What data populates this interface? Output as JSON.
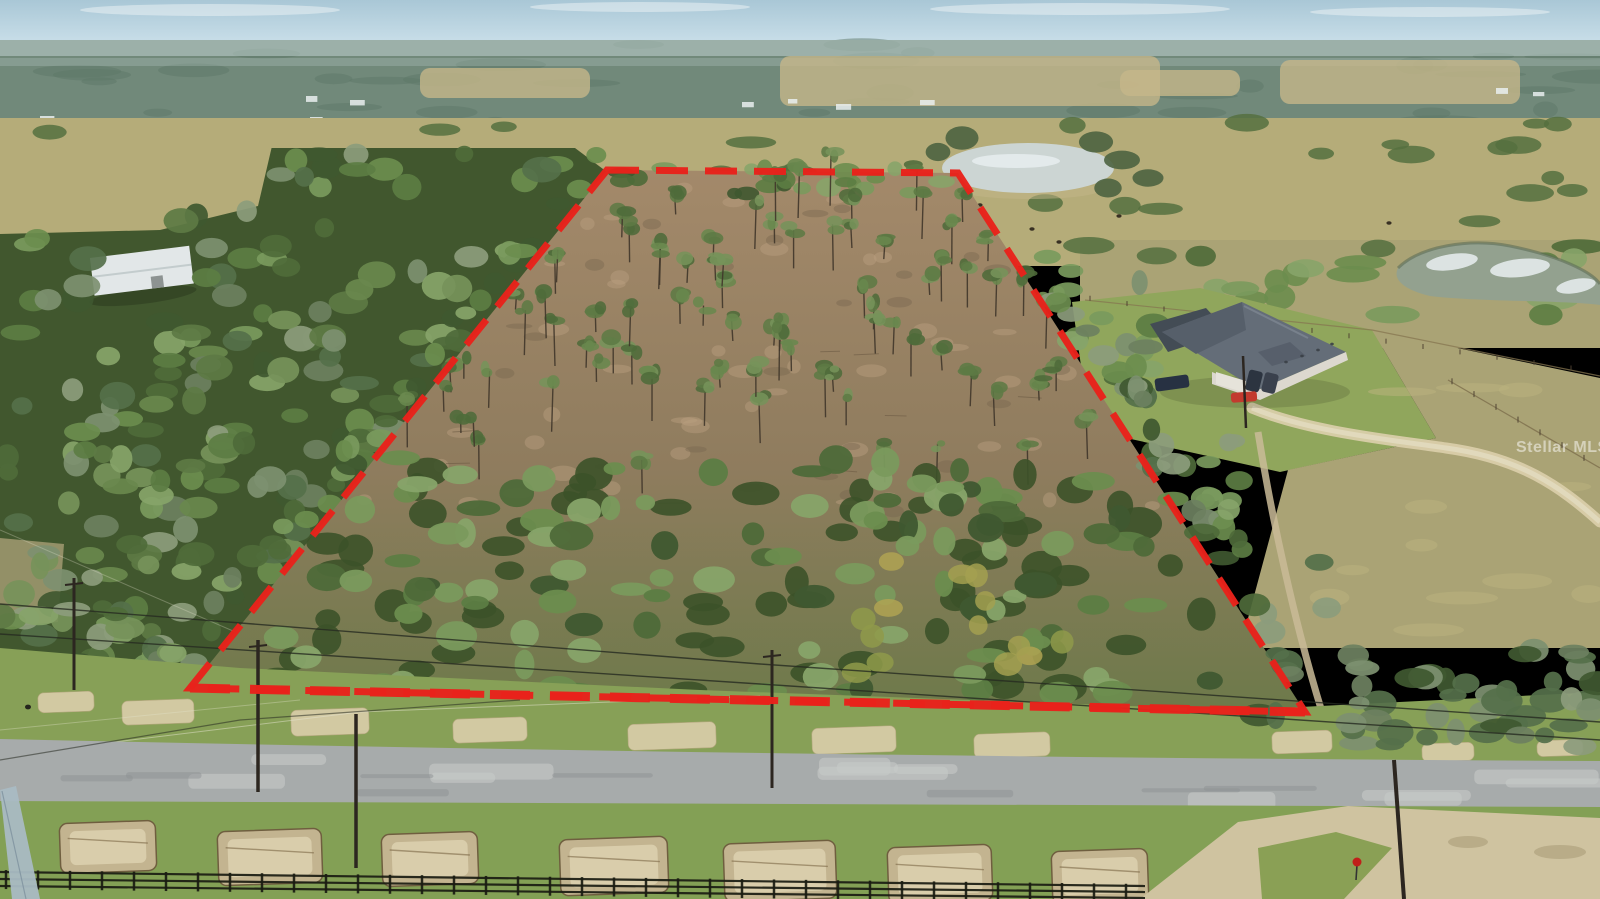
{
  "image": {
    "kind": "aerial-photograph",
    "width": 1600,
    "height": 899,
    "description": "Drone aerial photo of a wooded rural land parcel outlined with a red dashed property boundary, bordered by a country road with utility poles and a black board fence in the foreground, a neighboring house with a gray roof and cars to the right, pastures, cattle and ponds in the distance"
  },
  "watermark": {
    "text": "Stellar MLS",
    "x": 1516,
    "y": 439,
    "font_size": 16,
    "color": "rgba(255,255,255,0.5)"
  },
  "colors": {
    "sky_top": "#a9c7d6",
    "sky_low": "#cbe0ea",
    "cloud": "#eef4f6",
    "haze": "#c8d8d8",
    "distant": "#71897a",
    "distant_dark": "#5d7767",
    "field": "#c6b78a",
    "speck": "#e9eeef",
    "pasture": "#b5ac79",
    "pasture_right": "#aaa375",
    "lawn": "#90a65c",
    "dirt_top": "#a3896a",
    "dirt_low": "#8f7c5e",
    "dirt_light": "#bb9f80",
    "dirt_dark": "#76634d",
    "road": "#a7abab",
    "road_light": "#c6c9c8",
    "road_dark": "#8e9293",
    "verge": "#87a057",
    "sand": "#d9cda9",
    "sand_dark": "#b7a880",
    "fg_green": "#83a055",
    "dirt_patch": "#c7b694",
    "dirt_patch_rim": "#6e5b3e",
    "inter_sand": "#cfc3a0",
    "fence": "#1a1c12",
    "pole": "#2c2620",
    "pole_pale": "#a9bac3",
    "wire": "#262a20",
    "wire_light": "#e6e4cf",
    "roof": "#646d78",
    "roof_dark": "#565f6a",
    "roof_hl": "#7d8692",
    "enclosure": "#434c55",
    "wall": "#dcd8cf",
    "garage": "#e6e3da",
    "water_small": "#ccd5d3",
    "water_large": "#93a18f",
    "glint": "#e9eff1",
    "boundary_red": "#e8221b",
    "sign_red": "#c0201a",
    "cow": "#32291f",
    "forest_base": "#41572e",
    "pocket": "#98946a",
    "building_white": "#e2e7e8"
  },
  "boundary": {
    "points": [
      [
        607,
        170
      ],
      [
        958,
        173
      ],
      [
        1305,
        712
      ],
      [
        190,
        688
      ]
    ],
    "width": 7,
    "dash": "32 17",
    "bottom_width": 9,
    "bottom_dash": "40 20"
  },
  "cars": [
    {
      "name": "suv-dark",
      "x": 1172,
      "y": 383,
      "w": 34,
      "h": 13,
      "angle": -8,
      "color": "#273142"
    },
    {
      "name": "car-dark-1",
      "x": 1254,
      "y": 381,
      "w": 14,
      "h": 21,
      "angle": 14,
      "color": "#2c3440"
    },
    {
      "name": "car-dark-2",
      "x": 1270,
      "y": 383,
      "w": 14,
      "h": 20,
      "angle": 14,
      "color": "#3a414d"
    },
    {
      "name": "car-red",
      "x": 1244,
      "y": 397,
      "w": 26,
      "h": 10,
      "angle": -4,
      "color": "#c23a2e"
    }
  ],
  "verge_aprons": [
    [
      66,
      702,
      56,
      20
    ],
    [
      158,
      712,
      72,
      24
    ],
    [
      330,
      722,
      78,
      26
    ],
    [
      490,
      730,
      74,
      24
    ],
    [
      672,
      736,
      88,
      26
    ],
    [
      854,
      740,
      84,
      26
    ],
    [
      1012,
      745,
      76,
      24
    ],
    [
      1302,
      742,
      60,
      22
    ],
    [
      1448,
      752,
      52,
      18
    ],
    [
      1560,
      748,
      46,
      16
    ]
  ],
  "dirt_patches": [
    [
      60,
      822,
      96,
      50
    ],
    [
      218,
      830,
      104,
      54
    ],
    [
      382,
      833,
      96,
      52
    ],
    [
      560,
      838,
      108,
      56
    ],
    [
      724,
      842,
      112,
      58
    ],
    [
      888,
      846,
      104,
      56
    ],
    [
      1052,
      850,
      96,
      52
    ]
  ],
  "cows": [
    [
      36,
      168
    ],
    [
      54,
      176
    ],
    [
      140,
      206
    ],
    [
      208,
      212
    ],
    [
      240,
      170
    ],
    [
      1032,
      229
    ],
    [
      1059,
      242
    ],
    [
      1119,
      216
    ],
    [
      1389,
      223
    ],
    [
      980,
      205
    ]
  ],
  "building_specks": [
    [
      40,
      116
    ],
    [
      58,
      121
    ],
    [
      86,
      118
    ],
    [
      120,
      122
    ],
    [
      168,
      118
    ],
    [
      205,
      124
    ],
    [
      262,
      120
    ],
    [
      310,
      117
    ],
    [
      742,
      102
    ],
    [
      788,
      99
    ],
    [
      836,
      104
    ],
    [
      920,
      100
    ],
    [
      1496,
      88
    ],
    [
      1533,
      92
    ],
    [
      306,
      96
    ],
    [
      350,
      100
    ]
  ],
  "field_patches": [
    [
      780,
      56,
      380,
      50
    ],
    [
      1280,
      60,
      240,
      44
    ],
    [
      420,
      68,
      170,
      30
    ],
    [
      1120,
      70,
      120,
      26
    ]
  ],
  "poles": [
    {
      "x": 74,
      "y1": 578,
      "y2": 690,
      "w": 3,
      "arm": true,
      "lean": 0
    },
    {
      "x": 258,
      "y1": 640,
      "y2": 792,
      "w": 3.5,
      "arm": true,
      "lean": 0
    },
    {
      "x": 356,
      "y1": 714,
      "y2": 868,
      "w": 3.5,
      "arm": false,
      "lean": 0
    },
    {
      "x": 772,
      "y1": 650,
      "y2": 788,
      "w": 3,
      "arm": true,
      "lean": 0
    },
    {
      "x": 1404,
      "y1": 760,
      "y2": 899,
      "w": 4,
      "arm": false,
      "lean": -10
    }
  ],
  "wires": [
    "M0,604 L760,664 L1600,722",
    "M0,634 L760,684 L1600,740",
    "M0,760 L240,720 L520,700"
  ],
  "stop_sign": {
    "x": 1357,
    "y": 862,
    "r": 4.5
  },
  "fence": {
    "x_end": 1145,
    "y_left": 872,
    "y_right": 886,
    "rails": 3
  },
  "vegetation": {
    "seed": 13,
    "left_forest": 215,
    "pines": 82,
    "canopy_dark": 70,
    "canopy_light": 110,
    "autumn": 14,
    "right_band": 80,
    "overhang": 62,
    "top_row": 22,
    "mid_clumps": 46,
    "right_tree_row": 18,
    "pine_colors": [
      "#5d7a44",
      "#69884d",
      "#4f6b3a",
      "#76935a"
    ],
    "canopy_colors": [
      "#4e6a39",
      "#5c7d43",
      "#6b8d4e",
      "#7a9a5d",
      "#87a469",
      "#3f5830"
    ],
    "moss_colors": [
      "#7d9070",
      "#8c9c7c",
      "#6d8060",
      "#55704a"
    ],
    "autumn_colors": [
      "#a3a050",
      "#b0a352",
      "#8f9a4a"
    ]
  }
}
